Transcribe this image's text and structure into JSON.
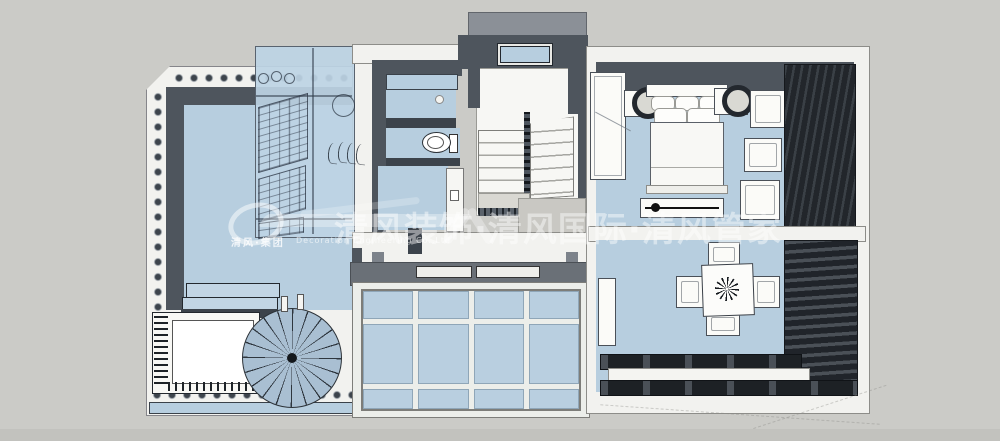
{
  "watermark": {
    "brand_text": "清风装饰·清风国际·清风管家",
    "logo_cn": "清风·集团",
    "logo_en": "Decoration Engineering Co.,Ltd"
  },
  "colors": {
    "background": "#cbcbc7",
    "floor_blue": "#b7cedf",
    "wall_dark": "#4e555d",
    "glass_blue": "#b9cfe0",
    "curtain_dark": "#22262b",
    "white_surface": "#f2f2ef",
    "watermark": "rgba(255,255,255,0.45)"
  },
  "scene": {
    "type": "3d-floor-plan-top-view",
    "rooms": [
      "terrace",
      "cloakroom",
      "bathroom",
      "stairwell",
      "master-bedroom",
      "dining-room",
      "sunroom-skylight"
    ],
    "furniture": [
      "spiral-staircase",
      "planter-box",
      "terrace-steps",
      "wardrobe",
      "double-bed",
      "nightstands-with-lamps",
      "armchairs",
      "tv-cabinet",
      "dining-table-with-centerpiece",
      "dining-chairs",
      "toilet",
      "curtains",
      "louvers"
    ]
  }
}
